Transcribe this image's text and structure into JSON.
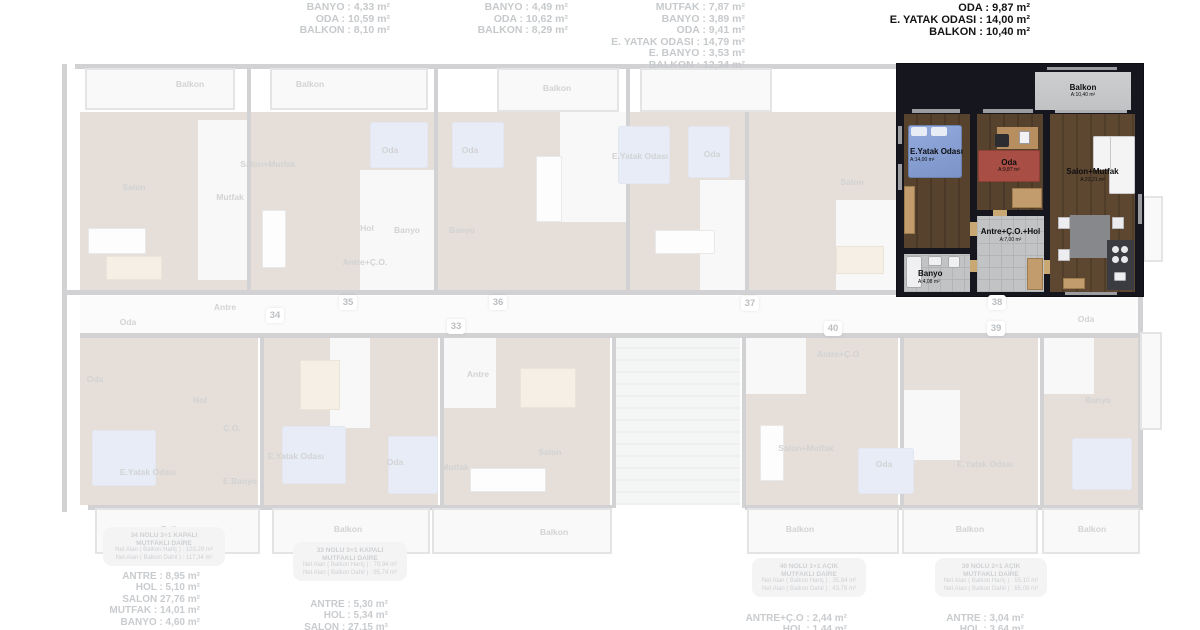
{
  "top_annotations": {
    "faded_columns": [
      {
        "right": 810,
        "top": 2,
        "lines": [
          "BANYO : 4,33 m²",
          "ODA : 10,59 m²",
          "BALKON : 8,10 m²"
        ]
      },
      {
        "right": 632,
        "top": 2,
        "lines": [
          "BANYO : 4,49 m²",
          "ODA : 10,62 m²",
          "BALKON : 8,29 m²"
        ]
      },
      {
        "right": 455,
        "top": 2,
        "lines": [
          "MUTFAK : 7,87 m²",
          "BANYO : 3,89 m²",
          "ODA : 9,41 m²",
          "E. YATAK ODASI : 14,79 m²",
          "E. BANYO : 3,53 m²",
          "BALKON : 12,34 m²"
        ]
      }
    ],
    "selected_column": {
      "right": 170,
      "top": 2,
      "lines": [
        "ODA : 9,87 m²",
        "E. YATAK ODASI : 14,00 m²",
        "BALKON : 10,40 m²"
      ]
    }
  },
  "selected_unit": {
    "unit_number": "38",
    "rooms": [
      {
        "name": "Balkon",
        "area": "A:10,40 m²"
      },
      {
        "name": "E.Yatak Odası",
        "area": "A:14,00 m²"
      },
      {
        "name": "Oda",
        "area": "A:9,87 m²"
      },
      {
        "name": "Salon+Mutfak",
        "area": "A:23,21 m²"
      },
      {
        "name": "Antre+Ç.O.+Hol",
        "area": "A:7,00 m²"
      },
      {
        "name": "Banyo",
        "area": "A:4,08 m²"
      }
    ]
  },
  "unit_badges": [
    {
      "number": "34",
      "x": 266,
      "y": 308
    },
    {
      "number": "35",
      "x": 339,
      "y": 295
    },
    {
      "number": "36",
      "x": 489,
      "y": 295
    },
    {
      "number": "33",
      "x": 447,
      "y": 319
    },
    {
      "number": "37",
      "x": 741,
      "y": 296
    },
    {
      "number": "40",
      "x": 824,
      "y": 321
    },
    {
      "number": "38",
      "x": 988,
      "y": 295
    },
    {
      "number": "39",
      "x": 987,
      "y": 321
    }
  ],
  "bottom_blocks": [
    {
      "unit": "34",
      "badge": {
        "x": 103,
        "y": 527,
        "w": 114,
        "title": [
          "34 NOLU 3+1 KAPALI",
          "MUTFAKLI DAİRE"
        ],
        "nets": [
          "Net Alan ( Balkon Hariç ) : 103,29 m²",
          "Net Alan ( Balkon Dahil ) : 117,34 m²"
        ]
      },
      "list": {
        "right": 1000,
        "top": 571,
        "lines": [
          "ANTRE : 8,95 m²",
          "HOL : 5,10 m²",
          "SALON 27,76 m²",
          "MUTFAK : 14,01 m²",
          "BANYO : 4,60 m²"
        ]
      }
    },
    {
      "unit": "33",
      "badge": {
        "x": 293,
        "y": 542,
        "w": 106,
        "title": [
          "33 NOLU 3+1 KAPALI",
          "MUTFAKLI DAİRE"
        ],
        "nets": [
          "Net Alan ( Balkon Hariç ) : 79,94 m²",
          "Net Alan ( Balkon Dahil ) : 95,74 m²"
        ]
      },
      "list": {
        "right": 812,
        "top": 599,
        "lines": [
          "ANTRE : 5,30 m²",
          "HOL : 5,34 m²",
          "SALON : 27,15 m²"
        ]
      }
    },
    {
      "unit": "40",
      "badge": {
        "x": 752,
        "y": 558,
        "w": 106,
        "title": [
          "40 NOLU 1+1 AÇIK",
          "MUTFAKLI DAİRE"
        ],
        "nets": [
          "Net Alan ( Balkon Hariç ) : 35,84 m²",
          "Net Alan ( Balkon Dahil ) : 43,78 m²"
        ]
      },
      "list": {
        "right": 353,
        "top": 613,
        "lines": [
          "ANTRE+Ç.O : 2,44 m²",
          "HOL : 1,44 m²"
        ]
      }
    },
    {
      "unit": "39",
      "badge": {
        "x": 935,
        "y": 558,
        "w": 104,
        "title": [
          "39 NOLU 2+1 AÇIK",
          "MUTFAKLI DAİRE"
        ],
        "nets": [
          "Net Alan ( Balkon Hariç ) : 55,10 m²",
          "Net Alan ( Balkon Dahil ) : 65,08 m²"
        ]
      },
      "list": {
        "right": 176,
        "top": 613,
        "lines": [
          "ANTRE : 3,04 m²",
          "HOL : 3,64 m²"
        ]
      }
    }
  ],
  "plan": {
    "rects": [
      {
        "c": "wall",
        "x": 75,
        "y": 64,
        "w": 1068,
        "h": 5
      },
      {
        "c": "wall",
        "x": 62,
        "y": 64,
        "w": 5,
        "h": 448
      },
      {
        "c": "wall",
        "x": 62,
        "y": 290,
        "w": 1081,
        "h": 5
      },
      {
        "c": "wall",
        "x": 80,
        "y": 333,
        "w": 1060,
        "h": 5
      },
      {
        "c": "wall",
        "x": 88,
        "y": 505,
        "w": 524,
        "h": 5
      },
      {
        "c": "wall",
        "x": 745,
        "y": 505,
        "w": 398,
        "h": 5
      },
      {
        "c": "wall",
        "x": 1138,
        "y": 296,
        "w": 5,
        "h": 214
      },
      {
        "c": "wall",
        "x": 247,
        "y": 68,
        "w": 4,
        "h": 224
      },
      {
        "c": "wall",
        "x": 434,
        "y": 68,
        "w": 4,
        "h": 224
      },
      {
        "c": "wall",
        "x": 626,
        "y": 68,
        "w": 4,
        "h": 224
      },
      {
        "c": "wall",
        "x": 745,
        "y": 68,
        "w": 4,
        "h": 224
      },
      {
        "c": "wall",
        "x": 260,
        "y": 336,
        "w": 4,
        "h": 172
      },
      {
        "c": "wall",
        "x": 440,
        "y": 336,
        "w": 4,
        "h": 172
      },
      {
        "c": "wall",
        "x": 612,
        "y": 336,
        "w": 4,
        "h": 172
      },
      {
        "c": "wall",
        "x": 742,
        "y": 336,
        "w": 4,
        "h": 172
      },
      {
        "c": "wall",
        "x": 900,
        "y": 336,
        "w": 4,
        "h": 172
      },
      {
        "c": "wall",
        "x": 1040,
        "y": 336,
        "w": 4,
        "h": 172
      },
      {
        "c": "balc",
        "x": 85,
        "y": 68,
        "w": 150,
        "h": 42
      },
      {
        "c": "balc",
        "x": 270,
        "y": 68,
        "w": 158,
        "h": 42
      },
      {
        "c": "balc",
        "x": 497,
        "y": 68,
        "w": 122,
        "h": 44
      },
      {
        "c": "balc",
        "x": 640,
        "y": 68,
        "w": 132,
        "h": 44
      },
      {
        "c": "balc",
        "x": 1143,
        "y": 196,
        "w": 20,
        "h": 66
      },
      {
        "c": "balc",
        "x": 1140,
        "y": 332,
        "w": 22,
        "h": 98
      },
      {
        "c": "wood",
        "x": 80,
        "y": 112,
        "w": 167,
        "h": 178
      },
      {
        "c": "tile",
        "x": 198,
        "y": 120,
        "w": 49,
        "h": 160
      },
      {
        "c": "wood",
        "x": 251,
        "y": 112,
        "w": 183,
        "h": 178
      },
      {
        "c": "tile",
        "x": 360,
        "y": 170,
        "w": 74,
        "h": 120
      },
      {
        "c": "wood",
        "x": 438,
        "y": 112,
        "w": 188,
        "h": 178
      },
      {
        "c": "tile",
        "x": 560,
        "y": 112,
        "w": 66,
        "h": 110
      },
      {
        "c": "wood",
        "x": 630,
        "y": 112,
        "w": 115,
        "h": 178
      },
      {
        "c": "tile",
        "x": 700,
        "y": 180,
        "w": 45,
        "h": 110
      },
      {
        "c": "wood",
        "x": 749,
        "y": 112,
        "w": 153,
        "h": 178
      },
      {
        "c": "tile",
        "x": 836,
        "y": 200,
        "w": 66,
        "h": 90
      },
      {
        "c": "corr",
        "x": 80,
        "y": 296,
        "w": 1058,
        "h": 37
      },
      {
        "c": "wood",
        "x": 80,
        "y": 338,
        "w": 178,
        "h": 167
      },
      {
        "c": "wood",
        "x": 264,
        "y": 338,
        "w": 174,
        "h": 167
      },
      {
        "c": "tile",
        "x": 330,
        "y": 338,
        "w": 40,
        "h": 90
      },
      {
        "c": "wood",
        "x": 444,
        "y": 338,
        "w": 166,
        "h": 167
      },
      {
        "c": "tile",
        "x": 444,
        "y": 338,
        "w": 52,
        "h": 70
      },
      {
        "c": "stair",
        "x": 616,
        "y": 338,
        "w": 124,
        "h": 167
      },
      {
        "c": "wood",
        "x": 746,
        "y": 338,
        "w": 152,
        "h": 167
      },
      {
        "c": "tile",
        "x": 746,
        "y": 338,
        "w": 60,
        "h": 56
      },
      {
        "c": "wood",
        "x": 904,
        "y": 338,
        "w": 134,
        "h": 167
      },
      {
        "c": "tile",
        "x": 904,
        "y": 390,
        "w": 56,
        "h": 70
      },
      {
        "c": "wood",
        "x": 1044,
        "y": 338,
        "w": 94,
        "h": 167
      },
      {
        "c": "tile",
        "x": 1044,
        "y": 338,
        "w": 50,
        "h": 56
      },
      {
        "c": "balc",
        "x": 95,
        "y": 508,
        "w": 165,
        "h": 46
      },
      {
        "c": "balc",
        "x": 272,
        "y": 508,
        "w": 158,
        "h": 46
      },
      {
        "c": "balc",
        "x": 432,
        "y": 508,
        "w": 180,
        "h": 46
      },
      {
        "c": "balc",
        "x": 747,
        "y": 508,
        "w": 152,
        "h": 46
      },
      {
        "c": "balc",
        "x": 902,
        "y": 508,
        "w": 136,
        "h": 46
      },
      {
        "c": "balc",
        "x": 1042,
        "y": 508,
        "w": 98,
        "h": 46
      },
      {
        "c": "bed",
        "x": 370,
        "y": 122,
        "w": 58,
        "h": 46
      },
      {
        "c": "bed",
        "x": 452,
        "y": 122,
        "w": 52,
        "h": 46
      },
      {
        "c": "bed",
        "x": 618,
        "y": 126,
        "w": 52,
        "h": 58
      },
      {
        "c": "bed",
        "x": 688,
        "y": 126,
        "w": 42,
        "h": 52
      },
      {
        "c": "bed",
        "x": 92,
        "y": 430,
        "w": 64,
        "h": 56
      },
      {
        "c": "bed",
        "x": 282,
        "y": 426,
        "w": 64,
        "h": 58
      },
      {
        "c": "bed",
        "x": 388,
        "y": 436,
        "w": 50,
        "h": 58
      },
      {
        "c": "bed",
        "x": 858,
        "y": 448,
        "w": 56,
        "h": 46
      },
      {
        "c": "bed",
        "x": 1072,
        "y": 438,
        "w": 60,
        "h": 52
      },
      {
        "c": "sofa",
        "x": 88,
        "y": 228,
        "w": 58,
        "h": 26
      },
      {
        "c": "sofa",
        "x": 262,
        "y": 210,
        "w": 24,
        "h": 58
      },
      {
        "c": "sofa",
        "x": 536,
        "y": 156,
        "w": 26,
        "h": 66
      },
      {
        "c": "sofa",
        "x": 655,
        "y": 230,
        "w": 60,
        "h": 24
      },
      {
        "c": "sofa",
        "x": 760,
        "y": 425,
        "w": 24,
        "h": 56
      },
      {
        "c": "sofa",
        "x": 470,
        "y": 468,
        "w": 76,
        "h": 24
      },
      {
        "c": "table",
        "x": 106,
        "y": 256,
        "w": 56,
        "h": 24
      },
      {
        "c": "table",
        "x": 520,
        "y": 368,
        "w": 56,
        "h": 40
      },
      {
        "c": "table",
        "x": 836,
        "y": 246,
        "w": 48,
        "h": 28
      },
      {
        "c": "table",
        "x": 300,
        "y": 360,
        "w": 40,
        "h": 50
      }
    ],
    "labels": [
      {
        "t": "Balkon",
        "s": "",
        "x": 190,
        "y": 80
      },
      {
        "t": "Balkon",
        "s": "",
        "x": 310,
        "y": 80
      },
      {
        "t": "Balkon",
        "s": "",
        "x": 557,
        "y": 84
      },
      {
        "t": "Salon",
        "s": "",
        "x": 134,
        "y": 183
      },
      {
        "t": "Mutfak",
        "s": "",
        "x": 230,
        "y": 193
      },
      {
        "t": "Salon+Mutfak",
        "s": "",
        "x": 268,
        "y": 160
      },
      {
        "t": "Oda",
        "s": "",
        "x": 390,
        "y": 146
      },
      {
        "t": "Oda",
        "s": "",
        "x": 470,
        "y": 146
      },
      {
        "t": "E.Yatak Odası",
        "s": "",
        "x": 640,
        "y": 152
      },
      {
        "t": "Oda",
        "s": "",
        "x": 712,
        "y": 150
      },
      {
        "t": "Salon",
        "s": "",
        "x": 852,
        "y": 178
      },
      {
        "t": "Hol",
        "s": "",
        "x": 367,
        "y": 224
      },
      {
        "t": "Banyo",
        "s": "",
        "x": 407,
        "y": 226
      },
      {
        "t": "Banyo",
        "s": "",
        "x": 462,
        "y": 226
      },
      {
        "t": "Antre+Ç.O.",
        "s": "",
        "x": 365,
        "y": 258
      },
      {
        "t": "Antre",
        "s": "",
        "x": 225,
        "y": 303
      },
      {
        "t": "Oda",
        "s": "",
        "x": 128,
        "y": 318
      },
      {
        "t": "Oda",
        "s": "",
        "x": 95,
        "y": 375
      },
      {
        "t": "Hol",
        "s": "",
        "x": 200,
        "y": 396
      },
      {
        "t": "Ç.O.",
        "s": "",
        "x": 232,
        "y": 424
      },
      {
        "t": "E.Yatak Odası",
        "s": "",
        "x": 148,
        "y": 468
      },
      {
        "t": "E.Banyo",
        "s": "",
        "x": 240,
        "y": 477
      },
      {
        "t": "E.Yatak Odası",
        "s": "",
        "x": 296,
        "y": 452
      },
      {
        "t": "Oda",
        "s": "",
        "x": 395,
        "y": 458
      },
      {
        "t": "Mutfak",
        "s": "",
        "x": 455,
        "y": 463
      },
      {
        "t": "Antre",
        "s": "",
        "x": 478,
        "y": 370
      },
      {
        "t": "Salon",
        "s": "",
        "x": 550,
        "y": 448
      },
      {
        "t": "Balkon",
        "s": "",
        "x": 175,
        "y": 525
      },
      {
        "t": "Balkon",
        "s": "",
        "x": 348,
        "y": 525
      },
      {
        "t": "Balkon",
        "s": "",
        "x": 554,
        "y": 528
      },
      {
        "t": "Antre+Ç.O",
        "s": "",
        "x": 838,
        "y": 350
      },
      {
        "t": "Salon+Mutfak",
        "s": "",
        "x": 806,
        "y": 444
      },
      {
        "t": "Oda",
        "s": "",
        "x": 884,
        "y": 460
      },
      {
        "t": "E.Yatak Odası",
        "s": "",
        "x": 985,
        "y": 460
      },
      {
        "t": "Banyo",
        "s": "",
        "x": 1098,
        "y": 396
      },
      {
        "t": "Oda",
        "s": "",
        "x": 1086,
        "y": 315
      },
      {
        "t": "Balkon",
        "s": "",
        "x": 800,
        "y": 525
      },
      {
        "t": "Balkon",
        "s": "",
        "x": 970,
        "y": 525
      },
      {
        "t": "Balkon",
        "s": "",
        "x": 1092,
        "y": 525
      }
    ]
  }
}
